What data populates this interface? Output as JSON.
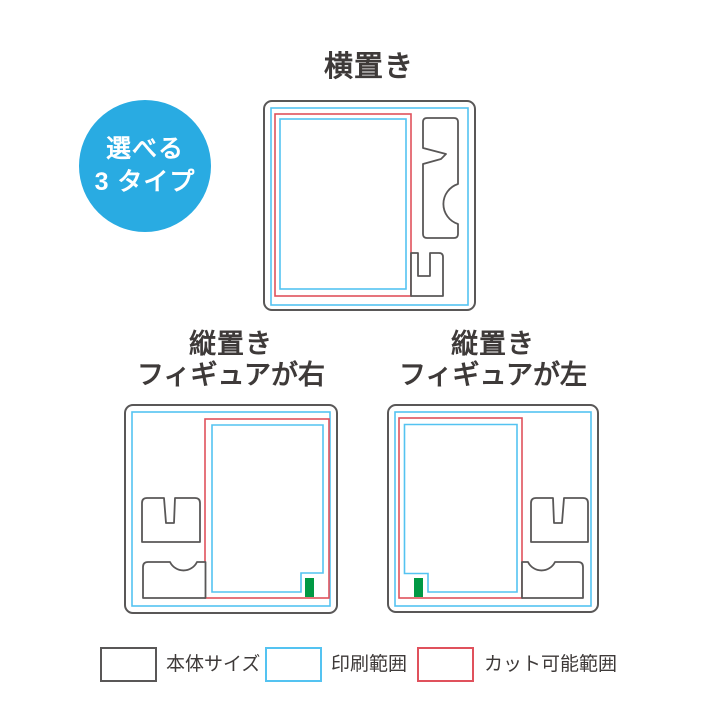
{
  "badge": {
    "line1": "選べる",
    "line2": "3 タイプ"
  },
  "sections": {
    "horizontal": {
      "title": "横置き"
    },
    "vertical_figure_right": {
      "title_line1": "縦置き",
      "title_line2": "フィギュアが右"
    },
    "vertical_figure_left": {
      "title_line1": "縦置き",
      "title_line2": "フィギュアが左"
    }
  },
  "legend": {
    "body": {
      "label": "本体サイズ",
      "color": "#595757"
    },
    "print": {
      "label": "印刷範囲",
      "color": "#54C3F1"
    },
    "cut": {
      "label": "カット可能範囲",
      "color": "#E0515C"
    }
  },
  "colors": {
    "badge_bg": "#29ABE2",
    "badge_text": "#FFFFFF",
    "body_line": "#595757",
    "print_line": "#54C3F1",
    "cut_line": "#E0515C",
    "stand_tab_green": "#009944",
    "text": "#3E3A39",
    "background": "#FFFFFF"
  }
}
